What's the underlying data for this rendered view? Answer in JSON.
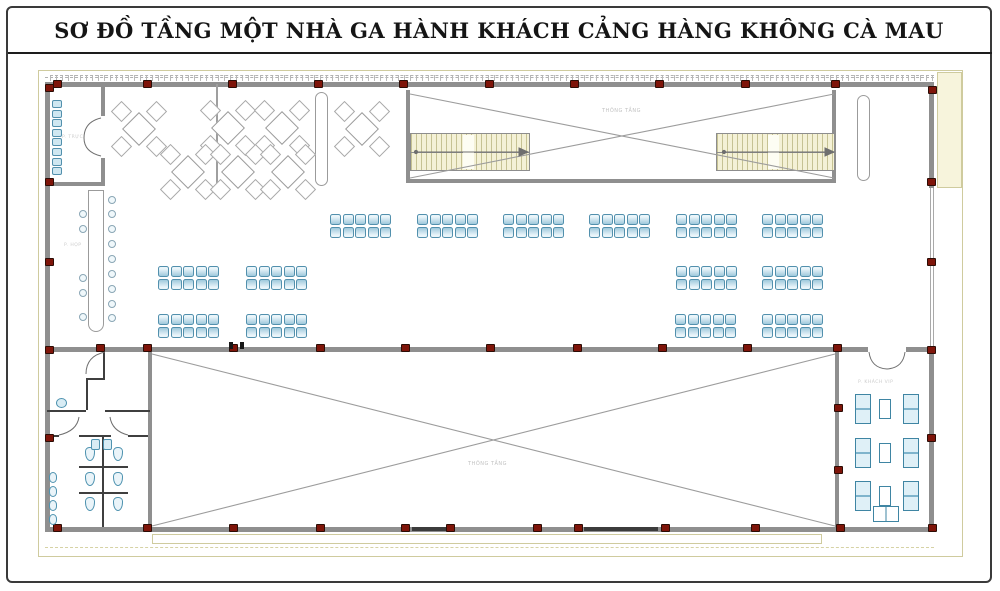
{
  "title": "SƠ ĐỒ TẦNG MỘT NHÀ GA HÀNH KHÁCH CẢNG HÀNG KHÔNG CÀ MAU",
  "labels": {
    "void_top": "THÔNG TẦNG",
    "void_bottom": "THÔNG TẦNG",
    "vip_room": "P. KHÁCH VIP",
    "office_room": "P. TRỰC",
    "meeting_room": "P. HỌP"
  },
  "colors": {
    "column_red": "#7e1409",
    "wall_gray": "#8f8f8f",
    "partition_dark": "#3f3f3f",
    "seat_fill": "#bcdcea",
    "seat_border": "#4f93b0",
    "stair_fill": "#f4f1d6",
    "exterior_cream": "#f7f4dc",
    "title_ink": "#151515"
  },
  "plan": {
    "columns": [
      [
        53,
        80
      ],
      [
        143,
        80
      ],
      [
        228,
        80
      ],
      [
        314,
        80
      ],
      [
        399,
        80
      ],
      [
        485,
        80
      ],
      [
        570,
        80
      ],
      [
        655,
        80
      ],
      [
        741,
        80
      ],
      [
        831,
        80
      ],
      [
        928,
        86
      ],
      [
        53,
        524
      ],
      [
        143,
        524
      ],
      [
        229,
        524
      ],
      [
        316,
        524
      ],
      [
        401,
        524
      ],
      [
        446,
        524
      ],
      [
        533,
        524
      ],
      [
        574,
        524
      ],
      [
        661,
        524
      ],
      [
        751,
        524
      ],
      [
        836,
        524
      ],
      [
        928,
        524
      ],
      [
        45,
        84
      ],
      [
        45,
        178
      ],
      [
        45,
        258
      ],
      [
        45,
        346
      ],
      [
        45,
        434
      ],
      [
        927,
        178
      ],
      [
        927,
        258
      ],
      [
        927,
        346
      ],
      [
        927,
        434
      ],
      [
        96,
        344
      ],
      [
        143,
        344
      ],
      [
        229,
        344
      ],
      [
        316,
        344
      ],
      [
        401,
        344
      ],
      [
        486,
        344
      ],
      [
        573,
        344
      ],
      [
        658,
        344
      ],
      [
        743,
        344
      ],
      [
        833,
        344
      ],
      [
        834,
        404
      ],
      [
        834,
        466
      ]
    ],
    "benches": [
      [
        330,
        214
      ],
      [
        417,
        214
      ],
      [
        503,
        214
      ],
      [
        589,
        214
      ],
      [
        676,
        214
      ],
      [
        762,
        214
      ],
      [
        158,
        266
      ],
      [
        246,
        266
      ],
      [
        676,
        266
      ],
      [
        762,
        266
      ],
      [
        158,
        314
      ],
      [
        246,
        314
      ],
      [
        675,
        314
      ],
      [
        762,
        314
      ]
    ],
    "cafe_tables": [
      [
        138,
        128
      ],
      [
        227,
        127
      ],
      [
        281,
        127
      ],
      [
        361,
        128
      ],
      [
        187,
        171
      ],
      [
        237,
        171
      ],
      [
        287,
        171
      ]
    ],
    "office_chairs": {
      "x": 52,
      "y0": 100,
      "step": 9.6,
      "count": 8
    },
    "utable_chairs_left": {
      "x": 79,
      "ys": [
        210,
        225,
        274,
        289,
        313
      ]
    },
    "utable_chairs_right": {
      "x": 108,
      "ys": [
        196,
        210,
        225,
        240,
        255,
        270,
        285,
        300,
        314
      ]
    },
    "urinals": {
      "x": 49,
      "ys": [
        472,
        486,
        500,
        514
      ]
    },
    "wcs": [
      [
        85,
        447
      ],
      [
        113,
        447
      ],
      [
        85,
        472
      ],
      [
        113,
        472
      ],
      [
        85,
        497
      ],
      [
        113,
        497
      ]
    ],
    "sinks_round": [
      [
        56,
        398
      ]
    ],
    "sinks_square": [
      [
        91,
        439
      ],
      [
        103,
        439
      ]
    ],
    "vip_sofa_rows": [
      394,
      438,
      481
    ],
    "vip_sofa_x": {
      "left": 855,
      "table": 879,
      "right": 903
    },
    "vip_bottom_table": [
      873,
      506
    ],
    "door_jambs": [
      [
        229,
        342
      ],
      [
        240,
        342
      ]
    ],
    "bottom_door_bars": [
      [
        412,
        34
      ],
      [
        584,
        74
      ]
    ]
  }
}
